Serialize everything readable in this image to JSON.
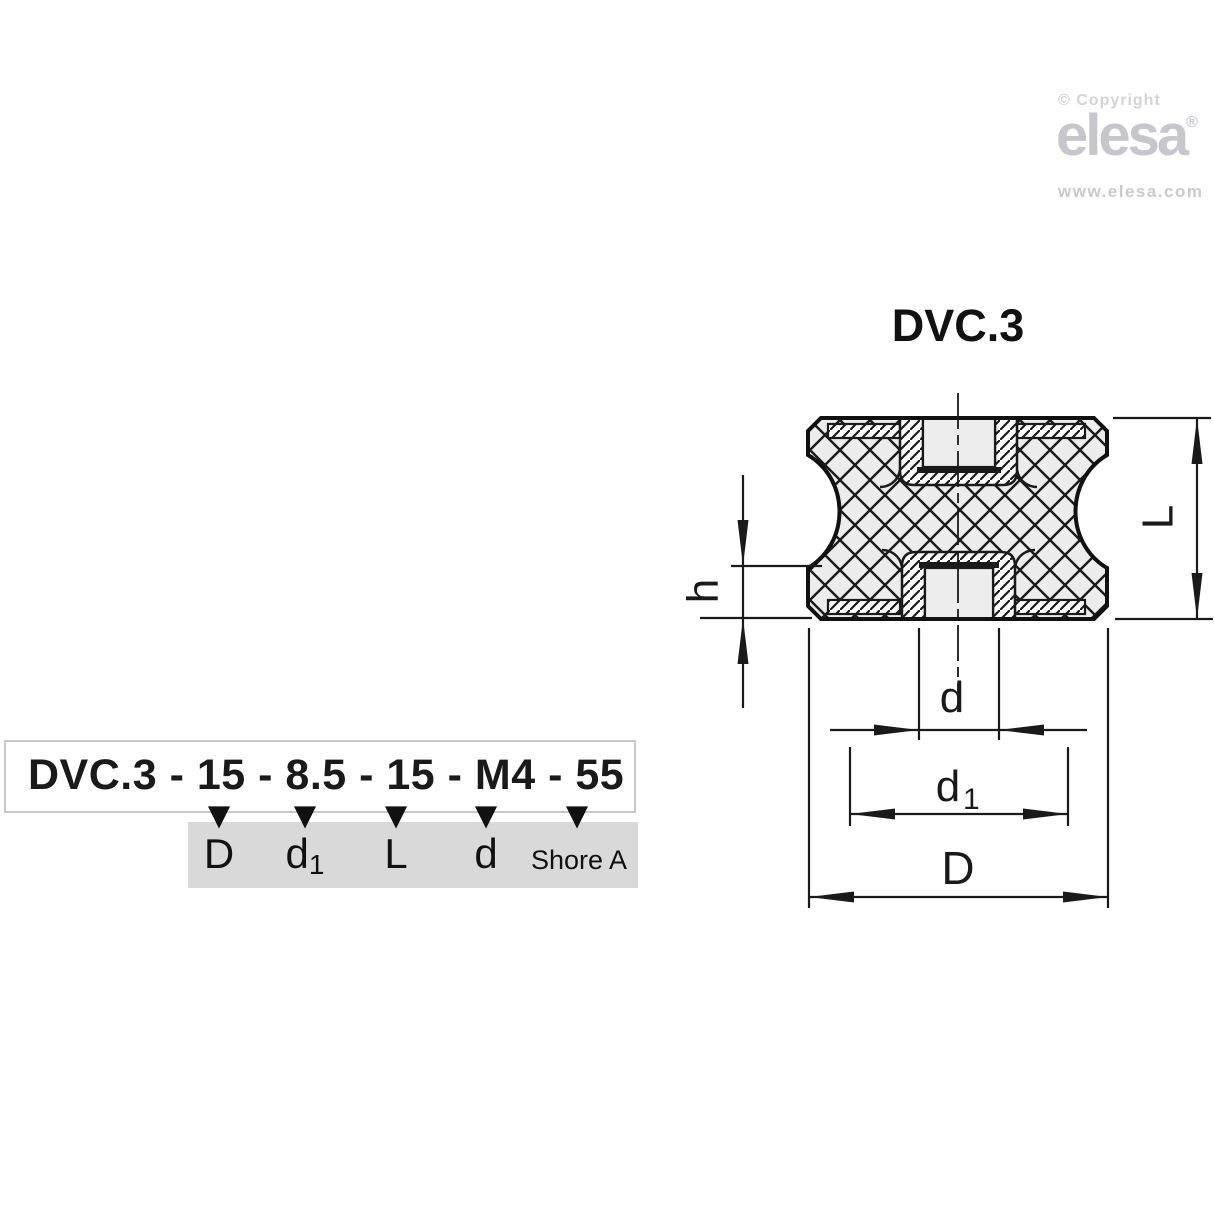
{
  "brand": {
    "copyright": "© Copyright",
    "logo": "elesa",
    "registered": "®",
    "url": "www.elesa.com"
  },
  "drawing": {
    "title": "DVC.3",
    "dims": {
      "L": "L",
      "h": "h",
      "d": "d",
      "d1_main": "d",
      "d1_sub": "1",
      "D": "D"
    }
  },
  "ordering": {
    "code": "DVC.3 - 15 - 8.5 - 15 - M4 - 55",
    "labels": [
      {
        "main": "D",
        "sub": ""
      },
      {
        "main": "d",
        "sub": "1"
      },
      {
        "main": "L",
        "sub": ""
      },
      {
        "main": "d",
        "sub": ""
      },
      {
        "main": "Shore A",
        "sub": ""
      }
    ]
  },
  "icons": {
    "down_arrow": "▼"
  },
  "colors": {
    "line": "#1a1a1a",
    "rubber_fill": "#ececec",
    "hole_fill": "#ededed",
    "gray_box": "#d9d9d9",
    "box_border": "#c9c9c9",
    "logo_gray": "#c6c6cc",
    "background": "#ffffff"
  }
}
